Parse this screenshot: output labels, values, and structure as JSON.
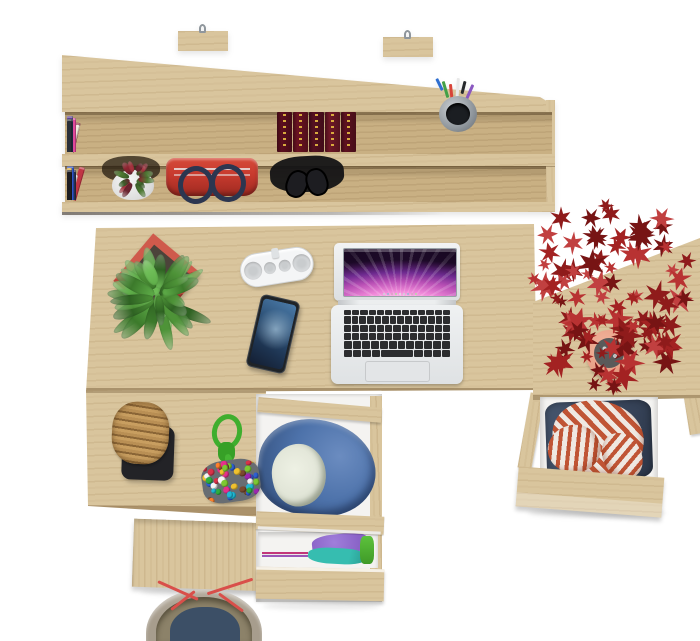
{
  "scene": {
    "description": "Top-down product photo of a light oak desk set: wall shelf with books, red handbag, headphones and pencil cup; desk with laptop, smartphone, pill speaker and green potted plant; open drawers with clothes; side cabinet with red maple plant; wicker stool, bead pouch and tote bag",
    "background": "#ffffff"
  },
  "colors": {
    "bg": "#ffffff",
    "wood": "#d9c59d",
    "wood-dark": "#c9b083",
    "metal": "#8f969c",
    "drawer-white": "#f4f3f1",
    "laptop-key": "#2c2d2f",
    "trackpad": "#e3e5e7",
    "screen-pink": "#ef87d8",
    "screen-purple": "#6d2a8f",
    "screen-dark": "#1d0a28",
    "phone-body": "#1f2327",
    "phone-screen": "#2c4f74",
    "speaker-body": "#f4f5f6",
    "speaker-grille": "#dcdee0",
    "pot-red": "#b8473a",
    "pot-red-dark": "#8e3129",
    "pot-white": "#f6f6f6",
    "terracotta": "#e8a187",
    "handbag-red": "#c73a2e",
    "handle-navy": "#2c3650",
    "headphones": "#121214",
    "cloth-blue": "#4d72aa",
    "cloth-cream": "#e0e4d6",
    "cloth-purple": "#8a63c7",
    "cloth-teal": "#36bdb0",
    "cloth-green": "#5dc23c",
    "cloth-magenta": "#c2357a",
    "stripe-red": "#c05535",
    "stripe-white": "#efe9e2",
    "denim": "#39465c",
    "wicker": "#b98f54",
    "wicker-dark": "#8a6536",
    "stool-base": "#232327",
    "rope-green": "#3fae2e",
    "pouch-base": "#686d72",
    "tote-khaki": "#a79d8d",
    "tote-navy": "#3c4f66",
    "tote-red": "#d94f4a",
    "tote-inner": "#8c8269"
  },
  "shelf": {
    "hooks": 2,
    "books_top": [
      {
        "c": "#2b3f7e",
        "w": 6,
        "h": 34
      },
      {
        "c": "#3a66c4",
        "w": 5,
        "h": 30
      },
      {
        "c": "#e8e6df",
        "w": 4,
        "h": 28
      },
      {
        "c": "#7b52b8",
        "w": 6,
        "h": 33
      },
      {
        "c": "#2e9aa6",
        "w": 5,
        "h": 30
      },
      {
        "c": "#eceae2",
        "w": 4,
        "h": 27
      },
      {
        "c": "#cfd8e2",
        "w": 4,
        "h": 28
      },
      {
        "c": "#e8d44c",
        "w": 5,
        "h": 36
      },
      {
        "c": "#efe7d2",
        "w": 5,
        "h": 30
      },
      {
        "c": "#222a3a",
        "w": 4,
        "h": 30
      },
      {
        "c": "#eae8e0",
        "w": 4,
        "h": 26
      },
      {
        "c": "#c23b33",
        "w": 5,
        "h": 32
      },
      {
        "c": "#e7e4da",
        "w": 4,
        "h": 28
      },
      {
        "c": "#a8c24a",
        "w": 6,
        "h": 34
      },
      {
        "c": "#3a3530",
        "w": 4,
        "h": 30
      },
      {
        "c": "#e9e6dd",
        "w": 4,
        "h": 28,
        "t": 8
      },
      {
        "c": "#8a2f3a",
        "w": 5,
        "h": 30,
        "t": 13,
        "g": 2
      },
      {
        "c": "#efe9d8",
        "w": 4,
        "h": 28,
        "t": 15,
        "g": 2
      },
      {
        "c": "#e0489a",
        "w": 6,
        "h": 34,
        "g": 3
      },
      {
        "c": "#c0327f",
        "w": 5,
        "h": 30
      },
      {
        "c": "#ece9e0",
        "w": 4,
        "h": 27
      },
      {
        "c": "#5b3f8f",
        "w": 6,
        "h": 36
      },
      {
        "c": "#d23a8c",
        "w": 5,
        "h": 33
      },
      {
        "c": "#2f6fd0",
        "w": 5,
        "h": 30
      },
      {
        "c": "#1f6f7a",
        "w": 5,
        "h": 29
      },
      {
        "c": "#2fa3b0",
        "w": 5,
        "h": 31
      },
      {
        "c": "#eae7de",
        "w": 4,
        "h": 26
      },
      {
        "c": "#243353",
        "w": 6,
        "h": 33
      },
      {
        "c": "#1d1d22",
        "w": 5,
        "h": 31
      },
      {
        "c": "#e8e5dc",
        "w": 4,
        "h": 27
      },
      {
        "c": "#55616e",
        "w": 5,
        "h": 30
      },
      {
        "c": "#2a2f38",
        "w": 5,
        "h": 33
      }
    ],
    "maroon_books": [
      "#5c0f1f",
      "#6b1322",
      "#551021",
      "#6f1827",
      "#5e1120"
    ],
    "books_bottom": [
      {
        "c": "#b5342c",
        "w": 6,
        "h": 30
      },
      {
        "c": "#c9a86a",
        "w": 5,
        "h": 28
      },
      {
        "c": "#e5ddc8",
        "w": 4,
        "h": 26
      },
      {
        "c": "#7d8c3f",
        "w": 5,
        "h": 29
      },
      {
        "c": "#3f6b3a",
        "w": 5,
        "h": 27
      },
      {
        "c": "#2f9aa8",
        "w": 6,
        "h": 31
      },
      {
        "c": "#e9e6de",
        "w": 4,
        "h": 26
      },
      {
        "c": "#232328",
        "w": 5,
        "h": 30
      },
      {
        "c": "#6b4a2f",
        "w": 5,
        "h": 28
      },
      {
        "c": "#7e2320",
        "w": 6,
        "h": 32
      },
      {
        "c": "#eae7df",
        "w": 4,
        "h": 27
      },
      {
        "c": "#d2b37c",
        "w": 5,
        "h": 28,
        "t": 10
      },
      {
        "c": "#2e2a26",
        "w": 5,
        "h": 30
      },
      {
        "c": "#c13544",
        "w": 6,
        "h": 34,
        "t": 16,
        "g": 3
      },
      {
        "c": "#ece9e1",
        "w": 4,
        "h": 26,
        "t": 16
      },
      {
        "c": "#27324e",
        "w": 5,
        "h": 30,
        "g": 4
      },
      {
        "c": "#7a4a28",
        "w": 6,
        "h": 31,
        "l": 1
      },
      {
        "c": "#e8dfc8",
        "w": 7,
        "h": 33,
        "l": 1
      },
      {
        "c": "#eceae2",
        "w": 4,
        "h": 27
      },
      {
        "c": "#2f55c8",
        "w": 7,
        "h": 34,
        "l": 1
      },
      {
        "c": "#2fb3c0",
        "w": 5,
        "h": 29
      },
      {
        "c": "#23272e",
        "w": 5,
        "h": 30
      },
      {
        "c": "#d8a52f",
        "w": 5,
        "h": 32
      },
      {
        "c": "#1c1c20",
        "w": 5,
        "h": 30
      }
    ],
    "pens": [
      "#2f6fd0",
      "#43a047",
      "#d84338",
      "#e8e8e8",
      "#25282c",
      "#8a57c0"
    ]
  },
  "laptop": {
    "keyboard_rows": [
      13,
      14,
      13,
      13,
      12,
      9
    ],
    "dock_dots": {
      "count": 9,
      "min": 2,
      "max": 2,
      "layout": "row",
      "seed": 4,
      "palette": [
        "#cfd4d8",
        "#9ab4d8",
        "#d8a4c4",
        "#b4d8a4",
        "#e0e0e0"
      ]
    }
  },
  "bead_bag": {
    "beads": {
      "count": 48,
      "min": 5,
      "max": 8,
      "seed": 7,
      "palette": [
        "#d8334a",
        "#2fae3e",
        "#2f5fd0",
        "#f0c12e",
        "#9c27b0",
        "#f5f5f5",
        "#ff7f2a",
        "#20b8d4",
        "#e5308c",
        "#7dc832",
        "#7a4a2f"
      ]
    }
  },
  "plants": {
    "green": {
      "count": 36,
      "seed": 11,
      "lmin": 22,
      "lmax": 52,
      "wmin": 8,
      "wmax": 14,
      "palette": [
        "#4e9338",
        "#3c7a2b",
        "#5fae49",
        "#2f6323",
        "#6fbe58"
      ]
    },
    "red_foliage": {
      "count": 95,
      "seed": 23,
      "rx": 84,
      "ry": 96,
      "smin": 12,
      "smax": 30,
      "palette": [
        "#a32222",
        "#8f1b1b",
        "#b83232",
        "#771414",
        "#c14040"
      ]
    },
    "shelf_mini": {
      "count": 14,
      "seed": 5,
      "lmin": 8,
      "lmax": 17,
      "wmin": 4,
      "wmax": 7,
      "palette": [
        "#8f2430",
        "#a8333f",
        "#4e7a33",
        "#6b2430",
        "#3c5f2a"
      ]
    }
  }
}
